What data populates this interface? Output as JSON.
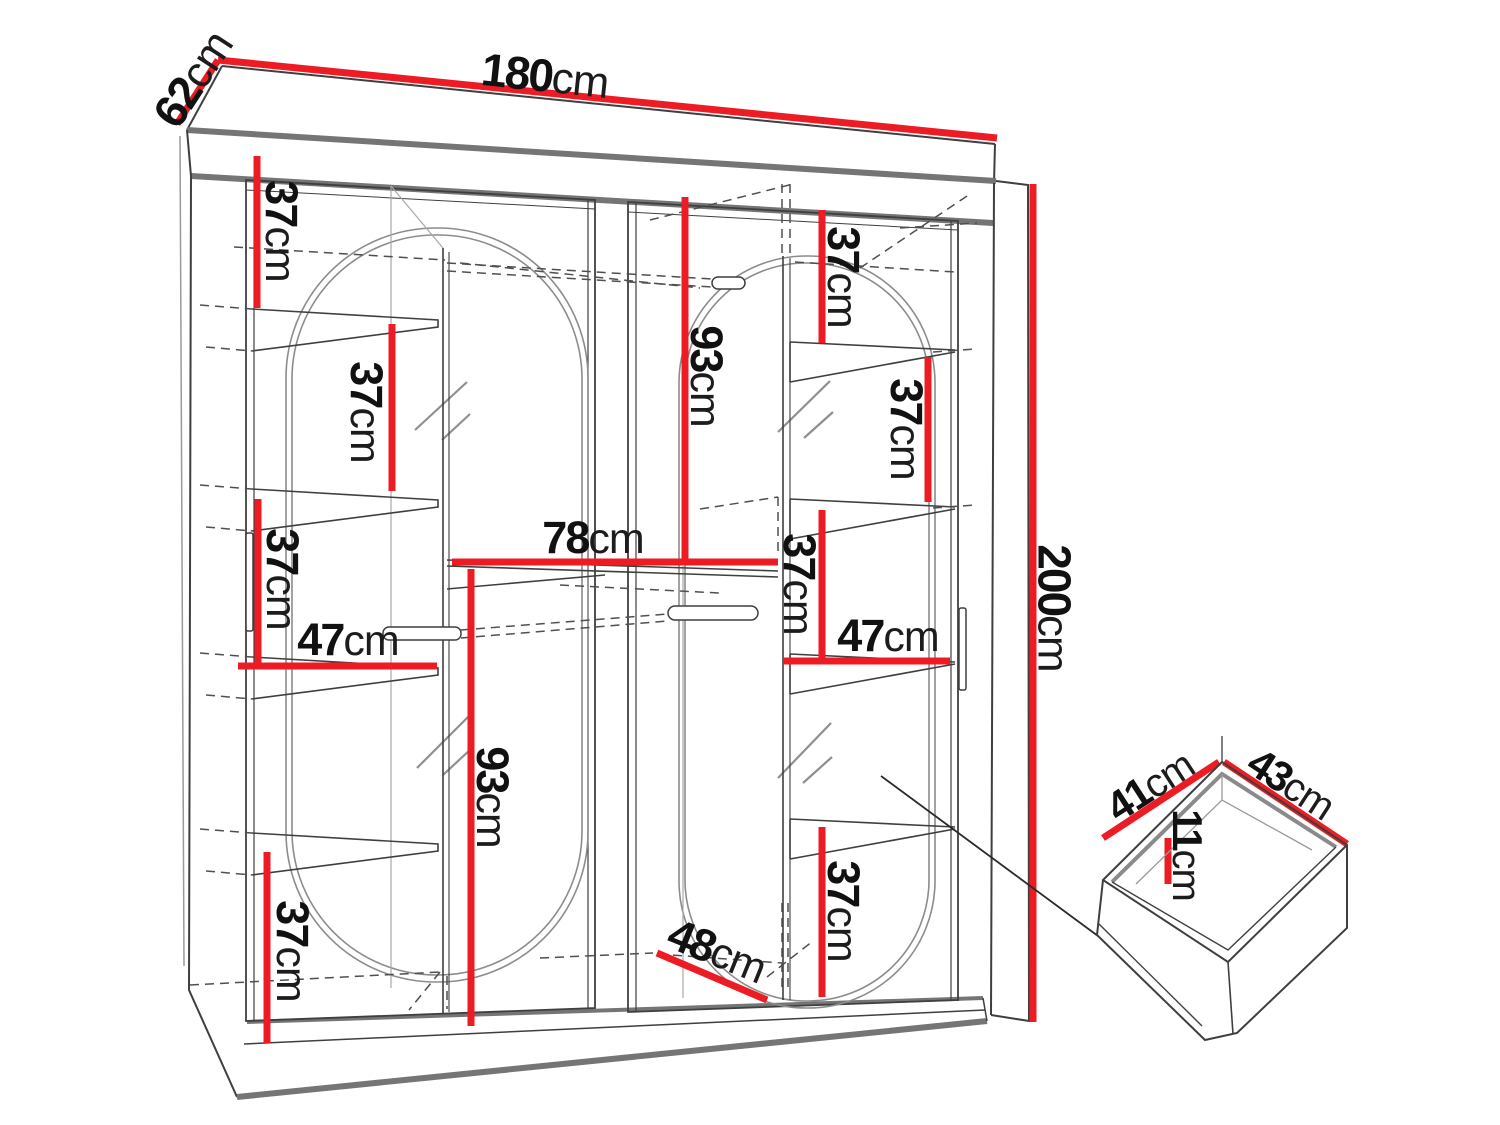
{
  "diagram": {
    "kind": "wardrobe-dimension-drawing",
    "unit": "cm",
    "background_color": "#ffffff",
    "dimension_color": "#ed1c24",
    "line_color": "#3f3f3f"
  },
  "wardrobe": {
    "overall": {
      "width": "180cm",
      "depth": "62cm",
      "height": "200cm"
    },
    "drawer_inset": {
      "depth": "41cm",
      "width": "43cm",
      "height": "11cm"
    }
  },
  "dimensions": [
    {
      "id": "overall-width",
      "value": "180",
      "unit": "cm",
      "x": 545,
      "y": 76,
      "rot": 6,
      "size": 46
    },
    {
      "id": "overall-depth",
      "value": "62",
      "unit": "cm",
      "x": 193,
      "y": 79,
      "rot": -57,
      "size": 46
    },
    {
      "id": "overall-height",
      "value": "200",
      "unit": "cm",
      "x": 1054,
      "y": 608,
      "rot": 90,
      "size": 46
    },
    {
      "id": "left-gap-top",
      "value": "37",
      "unit": "cm",
      "x": 281,
      "y": 231,
      "rot": 90,
      "size": 45
    },
    {
      "id": "left-gap-2",
      "value": "37",
      "unit": "cm",
      "x": 366,
      "y": 412,
      "rot": 90,
      "size": 45
    },
    {
      "id": "left-gap-3",
      "value": "37",
      "unit": "cm",
      "x": 282,
      "y": 579,
      "rot": 90,
      "size": 45
    },
    {
      "id": "left-shelf-width",
      "value": "47",
      "unit": "cm",
      "x": 348,
      "y": 640,
      "rot": 0,
      "size": 45
    },
    {
      "id": "left-hang-height",
      "value": "93",
      "unit": "cm",
      "x": 492,
      "y": 797,
      "rot": 90,
      "size": 45
    },
    {
      "id": "left-gap-bottom",
      "value": "37",
      "unit": "cm",
      "x": 292,
      "y": 951,
      "rot": 90,
      "size": 45
    },
    {
      "id": "middle-shelf-width",
      "value": "78",
      "unit": "cm",
      "x": 593,
      "y": 538,
      "rot": 0,
      "size": 45
    },
    {
      "id": "right-hang-height",
      "value": "93",
      "unit": "cm",
      "x": 706,
      "y": 376,
      "rot": 90,
      "size": 45
    },
    {
      "id": "right-gap-top",
      "value": "37",
      "unit": "cm",
      "x": 843,
      "y": 277,
      "rot": 90,
      "size": 45
    },
    {
      "id": "right-gap-2",
      "value": "37",
      "unit": "cm",
      "x": 906,
      "y": 429,
      "rot": 90,
      "size": 45
    },
    {
      "id": "right-gap-3",
      "value": "37",
      "unit": "cm",
      "x": 799,
      "y": 584,
      "rot": 90,
      "size": 45
    },
    {
      "id": "right-shelf-width",
      "value": "47",
      "unit": "cm",
      "x": 888,
      "y": 636,
      "rot": 0,
      "size": 45
    },
    {
      "id": "right-gap-bottom",
      "value": "37",
      "unit": "cm",
      "x": 843,
      "y": 911,
      "rot": 90,
      "size": 45
    },
    {
      "id": "floor-depth",
      "value": "48",
      "unit": "cm",
      "x": 717,
      "y": 951,
      "rot": 22,
      "size": 45
    },
    {
      "id": "drawer-depth",
      "value": "41",
      "unit": "cm",
      "x": 1150,
      "y": 786,
      "rot": -33,
      "size": 42
    },
    {
      "id": "drawer-width",
      "value": "43",
      "unit": "cm",
      "x": 1291,
      "y": 784,
      "rot": 33,
      "size": 42
    },
    {
      "id": "drawer-height",
      "value": "11",
      "unit": "cm",
      "x": 1187,
      "y": 855,
      "rot": 90,
      "size": 42
    }
  ]
}
